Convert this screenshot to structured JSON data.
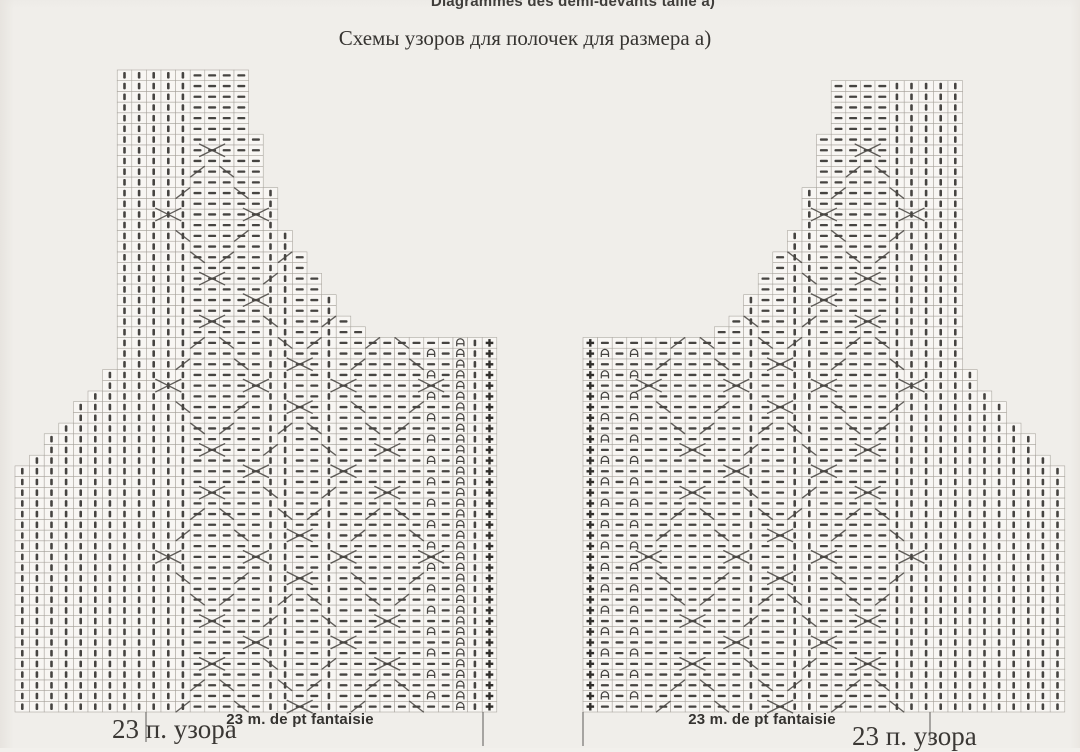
{
  "page": {
    "title_fr": "Diagrammes des demi-devants taille a)",
    "title_ru": "Схемы узоров для полочек для размера а)"
  },
  "labels": {
    "left_repeat_fr": "23 m. de pt fantaisie",
    "left_repeat_ru": "23 п. узора",
    "right_repeat_fr": "23 m. de pt fantaisie",
    "right_repeat_ru": "23 п. узора"
  },
  "colors": {
    "paper": "#f2f0ec",
    "cell_fill": "#faf8f5",
    "grid_line": "#a6a29b",
    "symbol": "#454340",
    "edge_symbol": "#2e2c29",
    "cable": "#4a4743",
    "tick": "#6b6965",
    "text": "#35322f"
  },
  "symbol_legend": {
    "k": "knit-stitch-vertical-bar",
    "p": "purl-stitch-horizontal-dash",
    "e": "arch-stitch-alternating-rows",
    "E": "arch-stitch-every-row",
    "+": "edge-stitch-plus"
  },
  "chart_data": [
    {
      "type": "knitting-chart",
      "name": "left-half-front",
      "repeat_stitch_count": 23,
      "x0": 15,
      "bottom": 712,
      "cell_w": 14.6,
      "cell_h": 10.7,
      "heights": [
        23,
        24,
        26,
        27,
        29,
        30,
        32,
        60,
        60,
        60,
        60,
        60,
        60,
        60,
        60,
        60,
        54,
        49,
        45,
        43,
        41,
        39,
        37,
        36,
        35,
        35,
        35,
        35,
        35,
        35,
        35,
        35,
        35
      ],
      "symbols": [
        "k",
        "k",
        "k",
        "k",
        "k",
        "k",
        "k",
        "k",
        "k",
        "k",
        "k",
        "k",
        "p",
        "p",
        "p",
        "p",
        "p",
        "k",
        "k",
        "p",
        "p",
        "k",
        "p",
        "p",
        "p",
        "p",
        "p",
        "p",
        "e",
        "p",
        "E",
        "k",
        "+"
      ],
      "cables": [
        [
          13,
          -2
        ],
        [
          13,
          14
        ],
        [
          13,
          30
        ],
        [
          13,
          46
        ],
        [
          19,
          6
        ],
        [
          19,
          22
        ],
        [
          19,
          38
        ],
        [
          25,
          -2
        ],
        [
          25,
          14
        ],
        [
          25,
          30
        ]
      ],
      "ticks": [
        [
          146,
          30
        ],
        [
          483,
          34
        ]
      ]
    },
    {
      "type": "knitting-chart",
      "name": "right-half-front",
      "repeat_stitch_count": 23,
      "x0": 583,
      "bottom": 712,
      "cell_w": 14.6,
      "cell_h": 10.7,
      "heights": [
        35,
        35,
        35,
        35,
        35,
        35,
        35,
        35,
        35,
        36,
        37,
        39,
        41,
        43,
        45,
        49,
        54,
        59,
        59,
        59,
        59,
        59,
        59,
        59,
        59,
        59,
        32,
        30,
        29,
        27,
        26,
        24,
        23
      ],
      "symbols": [
        "+",
        "e",
        "p",
        "e",
        "p",
        "p",
        "p",
        "p",
        "p",
        "p",
        "p",
        "k",
        "p",
        "p",
        "k",
        "k",
        "p",
        "p",
        "p",
        "p",
        "p",
        "k",
        "k",
        "k",
        "k",
        "k",
        "k",
        "k",
        "k",
        "k",
        "k",
        "k",
        "k"
      ],
      "cables": [
        [
          19,
          -2
        ],
        [
          19,
          14
        ],
        [
          19,
          30
        ],
        [
          19,
          46
        ],
        [
          13,
          6
        ],
        [
          13,
          22
        ],
        [
          13,
          38
        ],
        [
          7,
          -2
        ],
        [
          7,
          14
        ],
        [
          7,
          30
        ]
      ],
      "ticks": [
        [
          583,
          34
        ],
        [
          930,
          30
        ]
      ]
    }
  ]
}
